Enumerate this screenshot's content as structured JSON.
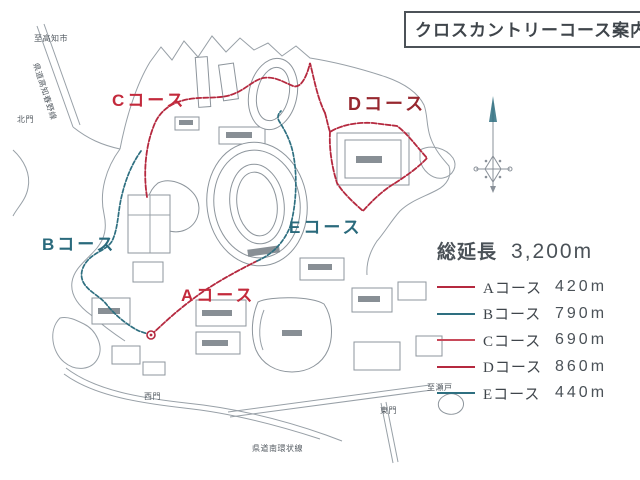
{
  "title": "クロスカントリーコース案内図",
  "colors": {
    "course_red": "#b5293f",
    "course_red_light": "#c84a5a",
    "course_teal": "#2e6f80",
    "label_red": "#c32a3c",
    "label_dark_red": "#97272f",
    "label_teal": "#2a6a7c",
    "ink": "#4b5258",
    "map_gray": "#98a0a7"
  },
  "map_labels": {
    "course_a": "Aコース",
    "course_b": "Bコース",
    "course_c": "Cコース",
    "course_d": "Dコース",
    "course_e": "Eコース",
    "to_kochi": "至高知市",
    "north_gate": "北門",
    "west_gate": "西門",
    "east_gate": "東門",
    "to_seto": "至瀬戸",
    "road_south_ring": "県道南環状線",
    "road_kochi_haruno": "県道高知春野線"
  },
  "legend": {
    "total_label": "総延長",
    "total_value": "3,200m",
    "items": [
      {
        "label": "Aコース",
        "value": "420m",
        "color": "#b5293f"
      },
      {
        "label": "Bコース",
        "value": "790m",
        "color": "#2e6f80"
      },
      {
        "label": "Cコース",
        "value": "690m",
        "color": "#c84a5a"
      },
      {
        "label": "Dコース",
        "value": "860m",
        "color": "#b5293f"
      },
      {
        "label": "Eコース",
        "value": "440m",
        "color": "#2e6f80"
      }
    ]
  }
}
